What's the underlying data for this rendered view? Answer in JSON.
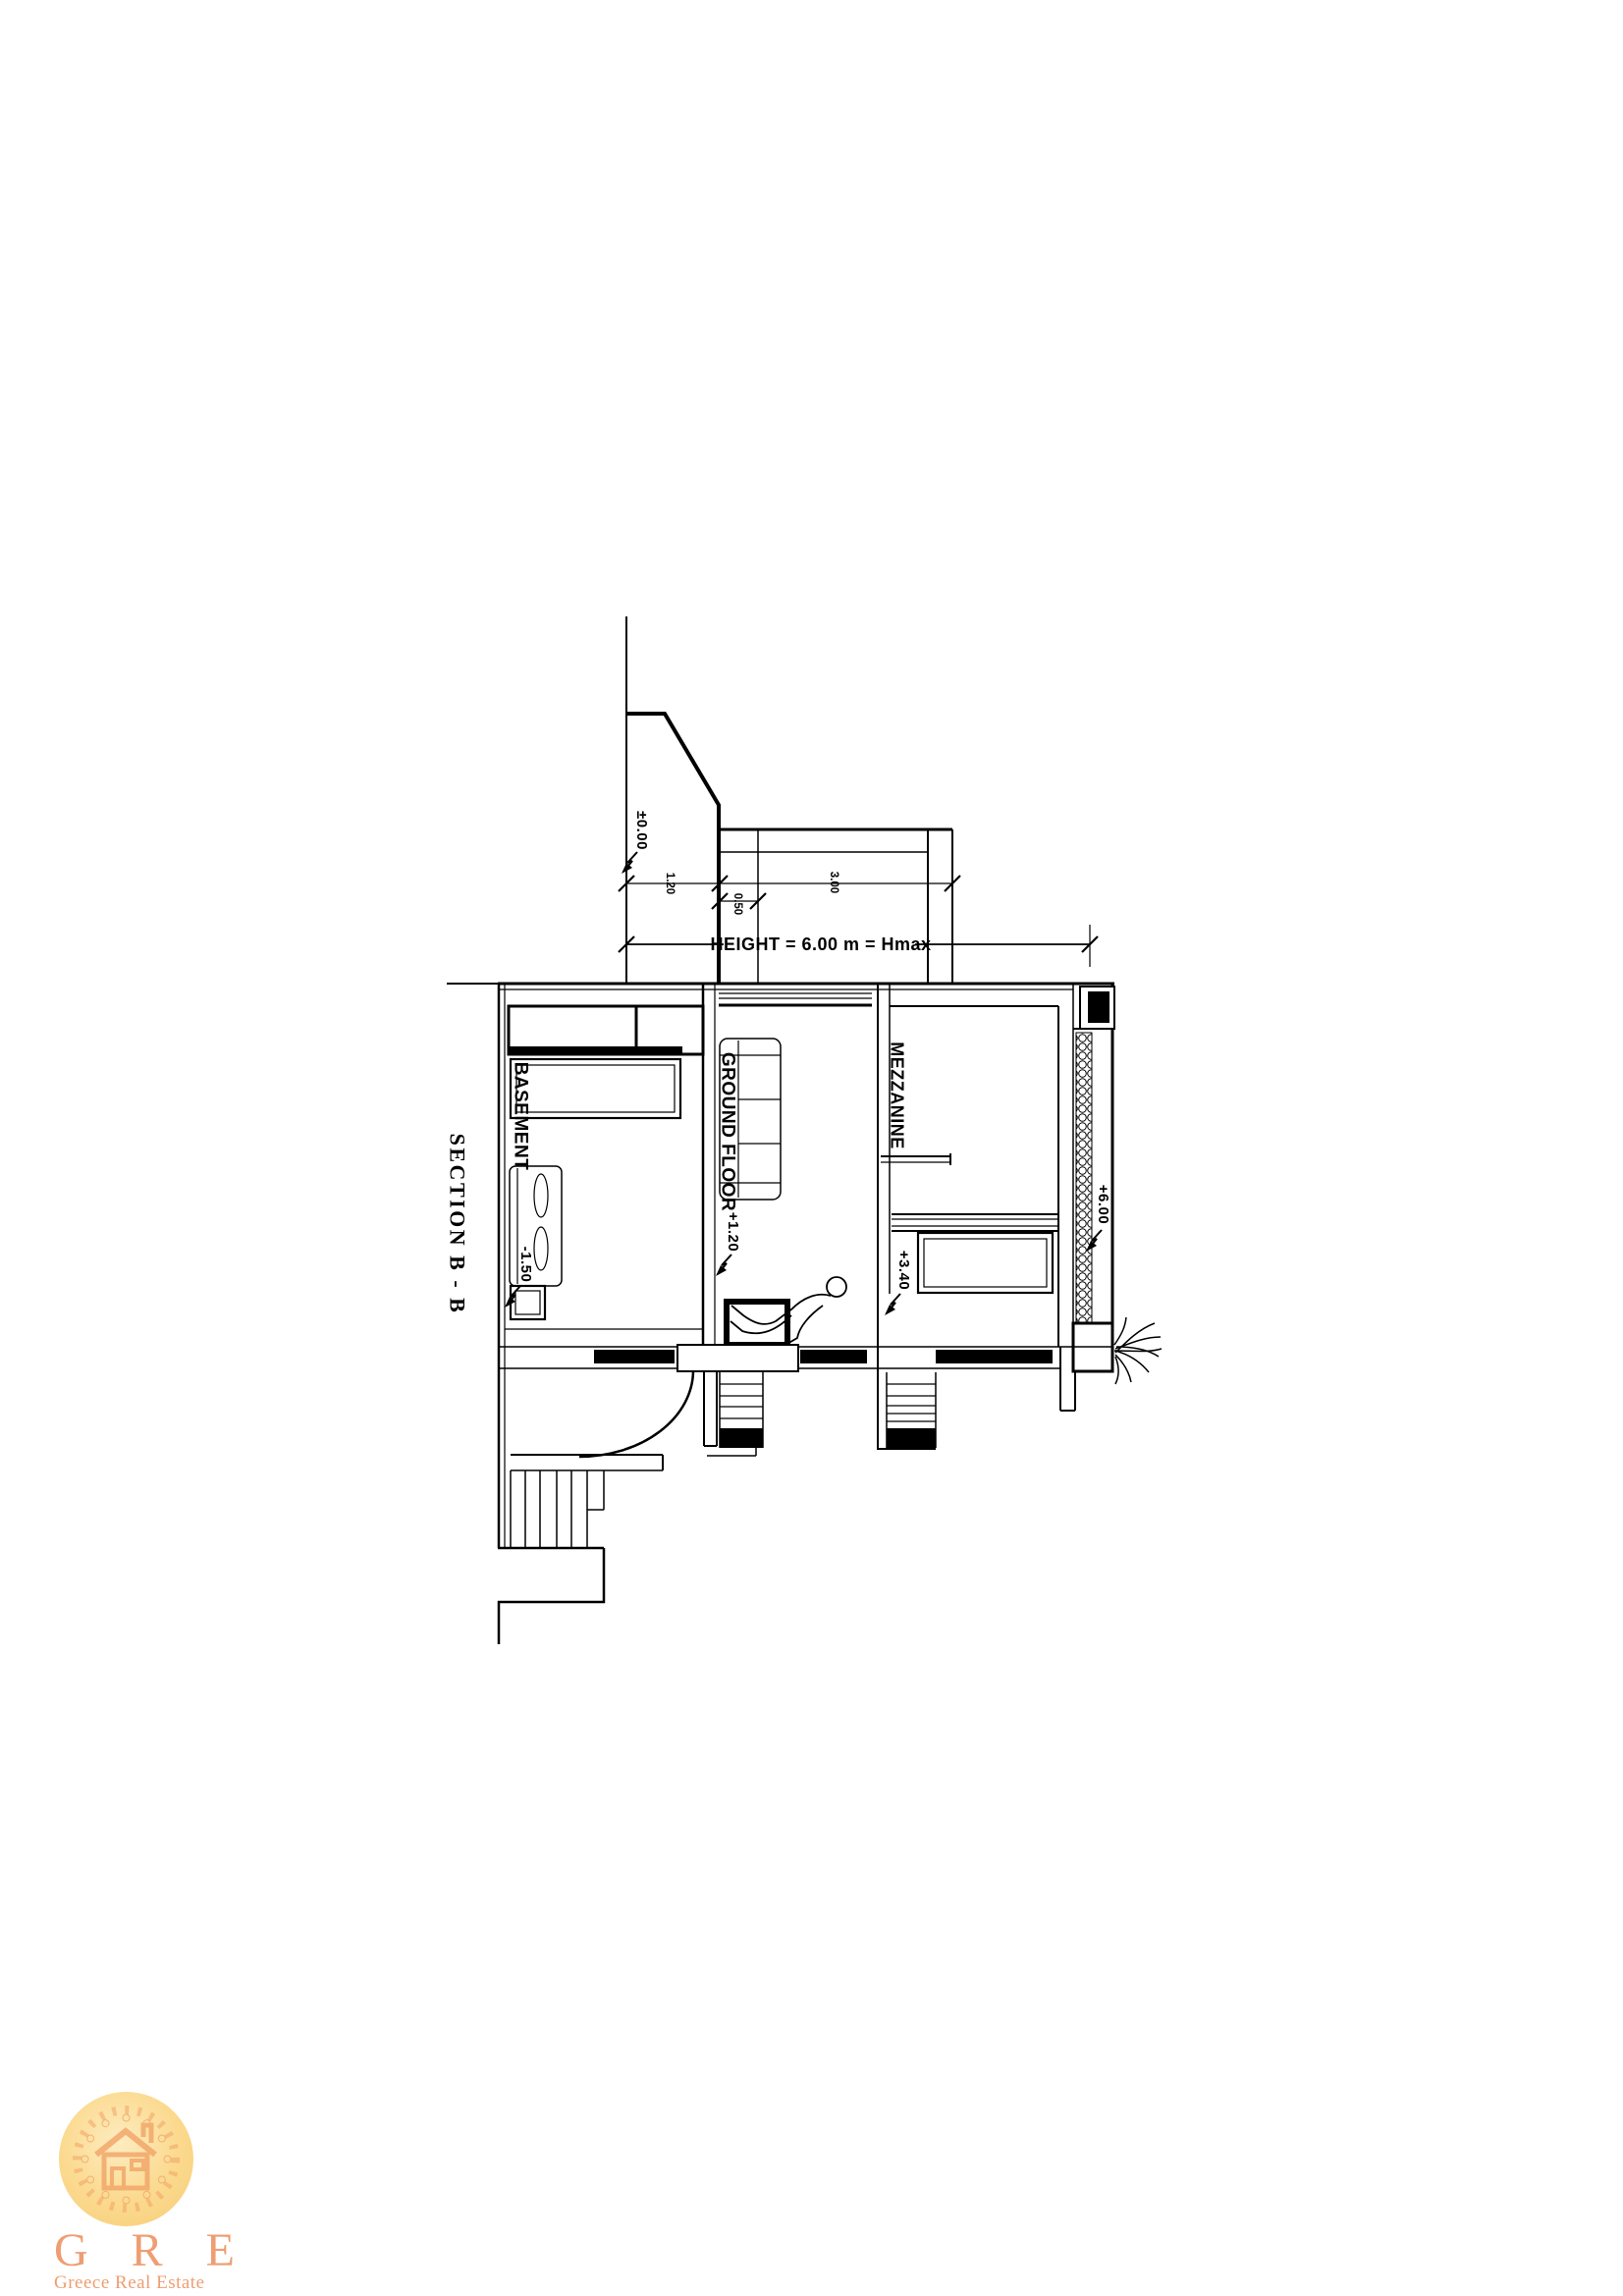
{
  "sheet": {
    "title": "SECTION B - B"
  },
  "labels": {
    "basement": "BASEMENT",
    "ground_floor": "GROUND FLOOR",
    "mezzanine": "MEZZANINE"
  },
  "levels": {
    "datum": "±0.00",
    "basement": "-1.50",
    "ground_floor": "+1.20",
    "mezzanine": "+3.40",
    "roof": "+6.00"
  },
  "dimensions": {
    "d1": "1.20",
    "d2": "0.50",
    "d3": "3.00",
    "height_note": "HEIGHT = 6.00 m = Hmax"
  },
  "logo": {
    "initials": "G R E",
    "company": "Greece Real Estate",
    "accent_color": "#ee9e72",
    "badge_color": "#fbd98d"
  }
}
